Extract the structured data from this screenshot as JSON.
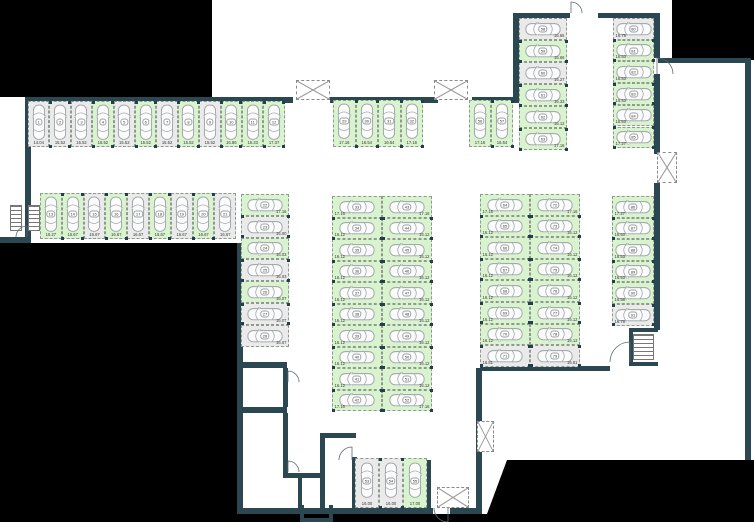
{
  "plan": {
    "title": "underground-parking-floor-plan",
    "colors": {
      "wall": "#2b4752",
      "free_space": "#d9f3ce",
      "occupied_space": "#eaeaea",
      "space_outline": "#8f9a8f",
      "car_outline": "#9aa2a6",
      "outside_mask": "#000000",
      "dim_text": "#3a3a3a"
    },
    "groups": [
      {
        "name": "row-1-12",
        "dir": "row",
        "x": 28,
        "y": 101,
        "cw": 21.4,
        "ch": 46,
        "open": "bottom",
        "spaces": [
          {
            "n": "1",
            "dim": "14.04",
            "state": "occupied"
          },
          {
            "n": "2",
            "dim": "15.52",
            "state": "occupied"
          },
          {
            "n": "3",
            "dim": "15.52",
            "state": "occupied"
          },
          {
            "n": "4",
            "dim": "15.52",
            "state": "free"
          },
          {
            "n": "5",
            "dim": "15.52",
            "state": "occupied"
          },
          {
            "n": "6",
            "dim": "15.52",
            "state": "free"
          },
          {
            "n": "7",
            "dim": "15.52",
            "state": "occupied"
          },
          {
            "n": "8",
            "dim": "15.52",
            "state": "free"
          },
          {
            "n": "9",
            "dim": "15.52",
            "state": "occupied"
          },
          {
            "n": "10",
            "dim": "16.86",
            "state": "free"
          },
          {
            "n": "11",
            "dim": "16.33",
            "state": "free"
          },
          {
            "n": "12",
            "dim": "17.37",
            "state": "free"
          }
        ]
      },
      {
        "name": "row-13-21",
        "dir": "row",
        "x": 40,
        "y": 193,
        "cw": 21.8,
        "ch": 46,
        "open": "bottom",
        "spaces": [
          {
            "n": "13",
            "dim": "16.27",
            "state": "free"
          },
          {
            "n": "14",
            "dim": "16.67",
            "state": "free"
          },
          {
            "n": "15",
            "dim": "16.67",
            "state": "occupied"
          },
          {
            "n": "16",
            "dim": "16.67",
            "state": "free"
          },
          {
            "n": "17",
            "dim": "16.67",
            "state": "occupied"
          },
          {
            "n": "18",
            "dim": "16.67",
            "state": "free"
          },
          {
            "n": "19",
            "dim": "16.67",
            "state": "occupied"
          },
          {
            "n": "20",
            "dim": "16.67",
            "state": "free"
          },
          {
            "n": "21",
            "dim": "16.67",
            "state": "occupied"
          }
        ]
      },
      {
        "name": "stack-22-28",
        "dir": "col",
        "x": 241,
        "y": 194,
        "cw": 48,
        "ch": 21.8,
        "open": "right",
        "spaces": [
          {
            "n": "22",
            "dim": "17.16",
            "state": "free"
          },
          {
            "n": "23",
            "dim": "16.00",
            "state": "occupied"
          },
          {
            "n": "24",
            "dim": "16.03",
            "state": "free"
          },
          {
            "n": "25",
            "dim": "16.03",
            "state": "occupied"
          },
          {
            "n": "26",
            "dim": "16.07",
            "state": "free"
          },
          {
            "n": "27",
            "dim": "16.07",
            "state": "occupied"
          },
          {
            "n": "28",
            "dim": "16.07",
            "state": "occupied"
          }
        ]
      },
      {
        "name": "row-29-32",
        "dir": "row",
        "x": 333,
        "y": 100,
        "cw": 22.5,
        "ch": 47,
        "open": "bottom",
        "spaces": [
          {
            "n": "29",
            "dim": "17.16",
            "state": "free"
          },
          {
            "n": "30",
            "dim": "16.54",
            "state": "free"
          },
          {
            "n": "31",
            "dim": "16.54",
            "state": "free"
          },
          {
            "n": "32",
            "dim": "17.16",
            "state": "free"
          }
        ]
      },
      {
        "name": "stack-33-42",
        "dir": "col",
        "x": 332,
        "y": 196,
        "cw": 50,
        "ch": 21.5,
        "open": "left",
        "spaces": [
          {
            "n": "33",
            "dim": "17.16",
            "state": "free"
          },
          {
            "n": "34",
            "dim": "16.12",
            "state": "free"
          },
          {
            "n": "35",
            "dim": "16.12",
            "state": "free"
          },
          {
            "n": "36",
            "dim": "16.12",
            "state": "free"
          },
          {
            "n": "37",
            "dim": "16.12",
            "state": "free"
          },
          {
            "n": "38",
            "dim": "16.12",
            "state": "free"
          },
          {
            "n": "39",
            "dim": "16.12",
            "state": "free"
          },
          {
            "n": "40",
            "dim": "16.12",
            "state": "free"
          },
          {
            "n": "41",
            "dim": "16.12",
            "state": "free"
          },
          {
            "n": "42",
            "dim": "17.16",
            "state": "free"
          }
        ]
      },
      {
        "name": "stack-43-52",
        "dir": "col",
        "x": 382,
        "y": 196,
        "cw": 50,
        "ch": 21.5,
        "open": "right",
        "spaces": [
          {
            "n": "43",
            "dim": "17.16",
            "state": "free"
          },
          {
            "n": "44",
            "dim": "16.12",
            "state": "free"
          },
          {
            "n": "45",
            "dim": "16.12",
            "state": "free"
          },
          {
            "n": "46",
            "dim": "16.12",
            "state": "free"
          },
          {
            "n": "47",
            "dim": "16.12",
            "state": "free"
          },
          {
            "n": "48",
            "dim": "16.12",
            "state": "free"
          },
          {
            "n": "49",
            "dim": "16.12",
            "state": "free"
          },
          {
            "n": "50",
            "dim": "16.12",
            "state": "free"
          },
          {
            "n": "51",
            "dim": "16.12",
            "state": "free"
          },
          {
            "n": "52",
            "dim": "17.16",
            "state": "free"
          }
        ]
      },
      {
        "name": "row-53-55",
        "dir": "row",
        "x": 355,
        "y": 458,
        "cw": 24,
        "ch": 50,
        "open": "bottom",
        "spaces": [
          {
            "n": "53",
            "dim": "16.00",
            "state": "occupied"
          },
          {
            "n": "54",
            "dim": "16.00",
            "state": "occupied"
          },
          {
            "n": "55",
            "dim": "17.00",
            "state": "free"
          }
        ]
      },
      {
        "name": "row-56-57",
        "dir": "row",
        "x": 469,
        "y": 100,
        "cw": 22,
        "ch": 47,
        "open": "bottom",
        "spaces": [
          {
            "n": "56",
            "dim": "17.16",
            "state": "free"
          },
          {
            "n": "57",
            "dim": "16.54",
            "state": "free"
          }
        ]
      },
      {
        "name": "stack-58-63",
        "dir": "col",
        "x": 519,
        "y": 18,
        "cw": 48,
        "ch": 22,
        "open": "right",
        "spaces": [
          {
            "n": "58",
            "dim": "16.65",
            "state": "occupied"
          },
          {
            "n": "59",
            "dim": "16.66",
            "state": "free"
          },
          {
            "n": "60",
            "dim": "16.27",
            "state": "occupied"
          },
          {
            "n": "61",
            "dim": "16.33",
            "state": "free"
          },
          {
            "n": "62",
            "dim": "16.12",
            "state": "free"
          },
          {
            "n": "63",
            "dim": "17.16",
            "state": "free"
          }
        ]
      },
      {
        "name": "stack-64-71",
        "dir": "col",
        "x": 480,
        "y": 194,
        "cw": 50,
        "ch": 21.6,
        "open": "left",
        "spaces": [
          {
            "n": "64",
            "dim": "17.16",
            "state": "free"
          },
          {
            "n": "65",
            "dim": "16.12",
            "state": "free"
          },
          {
            "n": "66",
            "dim": "16.12",
            "state": "free"
          },
          {
            "n": "67",
            "dim": "16.12",
            "state": "free"
          },
          {
            "n": "68",
            "dim": "16.12",
            "state": "free"
          },
          {
            "n": "69",
            "dim": "16.12",
            "state": "free"
          },
          {
            "n": "70",
            "dim": "16.12",
            "state": "free"
          },
          {
            "n": "71",
            "dim": "16.81",
            "state": "occupied"
          }
        ]
      },
      {
        "name": "stack-72-79",
        "dir": "col",
        "x": 530,
        "y": 194,
        "cw": 50,
        "ch": 21.6,
        "open": "right",
        "spaces": [
          {
            "n": "72",
            "dim": "17.16",
            "state": "free"
          },
          {
            "n": "73",
            "dim": "16.12",
            "state": "free"
          },
          {
            "n": "74",
            "dim": "16.12",
            "state": "free"
          },
          {
            "n": "75",
            "dim": "16.12",
            "state": "free"
          },
          {
            "n": "76",
            "dim": "16.12",
            "state": "free"
          },
          {
            "n": "77",
            "dim": "16.12",
            "state": "free"
          },
          {
            "n": "78",
            "dim": "16.12",
            "state": "free"
          },
          {
            "n": "79",
            "dim": "16.81",
            "state": "occupied"
          }
        ]
      },
      {
        "name": "stack-80-85",
        "dir": "col",
        "x": 613,
        "y": 18,
        "cw": 41,
        "ch": 21.7,
        "open": "left",
        "spaces": [
          {
            "n": "80",
            "dim": "16.79",
            "state": "occupied"
          },
          {
            "n": "81",
            "dim": "16.53",
            "state": "free"
          },
          {
            "n": "82",
            "dim": "16.53",
            "state": "free"
          },
          {
            "n": "83",
            "dim": "16.53",
            "state": "free"
          },
          {
            "n": "84",
            "dim": "16.53",
            "state": "free"
          },
          {
            "n": "85",
            "dim": "17.27",
            "state": "free"
          }
        ]
      },
      {
        "name": "stack-86-91",
        "dir": "col",
        "x": 612,
        "y": 196,
        "cw": 42,
        "ch": 21.6,
        "open": "left",
        "spaces": [
          {
            "n": "86",
            "dim": "17.27",
            "state": "free"
          },
          {
            "n": "87",
            "dim": "16.53",
            "state": "free"
          },
          {
            "n": "88",
            "dim": "16.53",
            "state": "free"
          },
          {
            "n": "89",
            "dim": "16.53",
            "state": "free"
          },
          {
            "n": "90",
            "dim": "16.58",
            "state": "free"
          },
          {
            "n": "91",
            "dim": "16.78",
            "state": "occupied"
          }
        ]
      }
    ],
    "walls": [
      [
        25,
        97,
        268,
        6
      ],
      [
        25,
        97,
        6,
        146
      ],
      [
        0,
        237,
        31,
        6
      ],
      [
        330,
        97,
        108,
        6
      ],
      [
        472,
        97,
        47,
        6
      ],
      [
        513,
        13,
        6,
        90
      ],
      [
        513,
        13,
        57,
        5
      ],
      [
        598,
        13,
        62,
        5
      ],
      [
        654,
        13,
        6,
        45
      ],
      [
        654,
        74,
        6,
        80
      ],
      [
        658,
        58,
        93,
        5
      ],
      [
        745,
        63,
        6,
        397
      ],
      [
        654,
        183,
        6,
        147
      ],
      [
        480,
        366,
        130,
        5
      ],
      [
        237,
        243,
        6,
        271
      ],
      [
        237,
        362,
        50,
        6
      ],
      [
        237,
        407,
        50,
        6
      ],
      [
        283,
        368,
        5,
        39
      ],
      [
        283,
        413,
        5,
        60
      ],
      [
        283,
        473,
        42,
        5
      ],
      [
        298,
        478,
        4,
        36
      ],
      [
        320,
        433,
        5,
        81
      ],
      [
        320,
        433,
        36,
        5
      ],
      [
        352,
        457,
        5,
        51
      ],
      [
        427,
        460,
        4,
        48
      ],
      [
        237,
        508,
        196,
        6
      ],
      [
        450,
        508,
        30,
        6
      ],
      [
        476,
        368,
        6,
        146
      ],
      [
        300,
        505,
        4,
        17
      ],
      [
        300,
        518,
        33,
        4
      ],
      [
        329,
        505,
        4,
        17
      ],
      [
        629,
        328,
        29,
        4
      ],
      [
        629,
        328,
        4,
        38
      ],
      [
        629,
        362,
        29,
        4
      ]
    ],
    "masks": {
      "rects": [
        [
          0,
          0,
          212,
          97
        ],
        [
          672,
          0,
          82,
          60
        ],
        [
          0,
          243,
          237,
          279
        ],
        [
          237,
          514,
          253,
          8
        ]
      ],
      "polygon": [
        [
          484,
          522
        ],
        [
          507,
          460
        ],
        [
          754,
          460
        ],
        [
          754,
          522
        ]
      ]
    },
    "shafts": [
      [
        296,
        80,
        34,
        20
      ],
      [
        434,
        80,
        34,
        20
      ],
      [
        657,
        152,
        20,
        31
      ],
      [
        477,
        421,
        17,
        31
      ],
      [
        437,
        487,
        32,
        21
      ]
    ],
    "stairs": [
      [
        10,
        205,
        12,
        26
      ],
      [
        28,
        205,
        12,
        26
      ],
      [
        633,
        334,
        21,
        26
      ]
    ],
    "doors": [
      {
        "hx": 571,
        "hy": 13,
        "r": 11,
        "leaf": "up",
        "sweep": "cw"
      },
      {
        "hx": 657,
        "hy": 74,
        "r": 16,
        "leaf": "up",
        "sweep": "cw"
      },
      {
        "hx": 630,
        "hy": 362,
        "r": 20,
        "leaf": "up",
        "sweep": "ccw"
      },
      {
        "hx": 352,
        "hy": 460,
        "r": 13,
        "leaf": "up",
        "sweep": "ccw"
      },
      {
        "hx": 448,
        "hy": 508,
        "r": 14,
        "leaf": "down",
        "sweep": "cw"
      },
      {
        "hx": 288,
        "hy": 382,
        "r": 11,
        "leaf": "up",
        "sweep": "cw"
      },
      {
        "hx": 288,
        "hy": 472,
        "r": 11,
        "leaf": "up",
        "sweep": "cw"
      },
      {
        "hx": 27,
        "hy": 237,
        "r": 11,
        "leaf": "up",
        "sweep": "ccw"
      }
    ]
  }
}
